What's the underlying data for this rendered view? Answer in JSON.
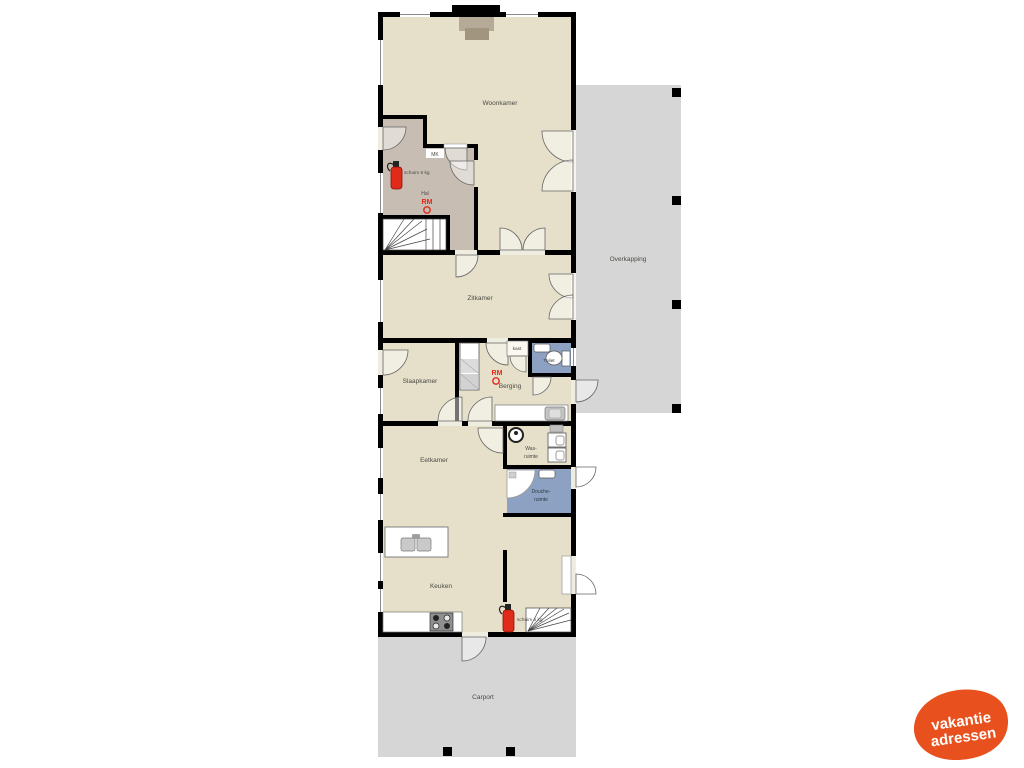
{
  "plan": {
    "rooms": {
      "woonkamer": "Woonkamer",
      "hal": "Hal",
      "mk": "MK",
      "zitkamer": "Zitkamer",
      "slaapkamer": "Slaapkamer",
      "berging": "Berging",
      "kast": "kast",
      "toilet": "Toilet",
      "wasruimte_line1": "Was-",
      "wasruimte_line2": "ruimte",
      "doucheruimte_line1": "Douche-",
      "doucheruimte_line2": "ruimte",
      "eetkamer": "Eetkamer",
      "keuken": "Keuken",
      "carport": "Carport",
      "overkapping": "Overkapping"
    },
    "annotations": {
      "smoke_detector_code": "RM",
      "extinguisher_text": "schuim 6 kg"
    },
    "colors": {
      "wall": "#000000",
      "floor": "#e6e0ca",
      "hall_floor": "#c7bdb3",
      "wet_room_blue": "#8da2c2",
      "outdoor_grey": "#d6d6d6",
      "safety_red": "#e02a1a",
      "logo_orange": "#e8511d"
    },
    "icons": {
      "fire-extinguisher-icon": "red cylinder with hose",
      "smoke-detector-icon": "red circle outline",
      "washing-machine-icon": "circle with center dot",
      "stove-icon": "grey square with 4 burners",
      "sink-icon": "grey basin square",
      "toilet-icon": "oval bowl with cistern",
      "shower-icon": "quarter-circle shower tray",
      "stairs-icon": "fanned treads",
      "wardrobe-icon": "shelved closet column",
      "chimney-icon": "black hearth block"
    }
  },
  "logo": {
    "line1": "vakantie",
    "line2": "adressen"
  }
}
